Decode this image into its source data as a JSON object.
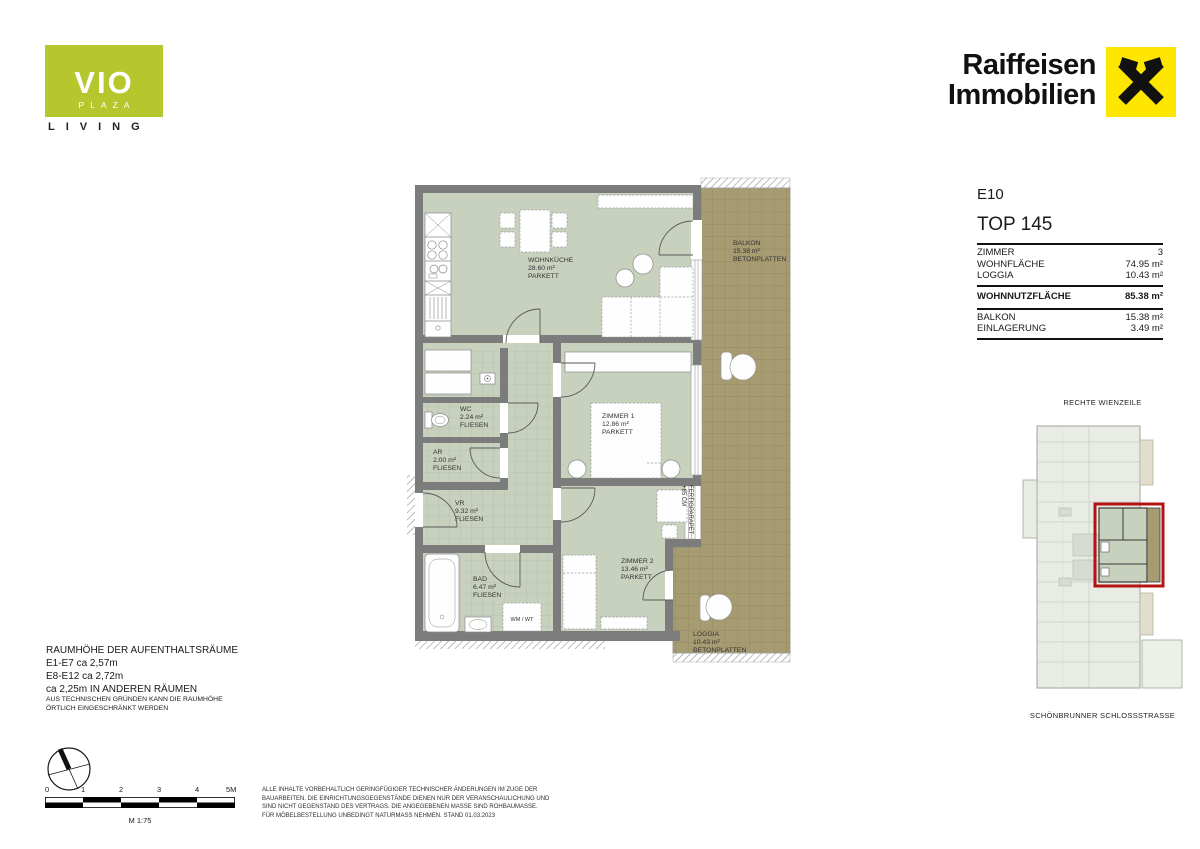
{
  "branding": {
    "vio_name": "VIO",
    "vio_sub": "PLAZA",
    "vio_tag": "LIVING",
    "raiffeisen_l1": "Raiffeisen",
    "raiffeisen_l2": "Immobilien"
  },
  "unit": {
    "floor": "E10",
    "top_number": "TOP 145",
    "rows": [
      {
        "label": "ZIMMER",
        "value": "3"
      },
      {
        "label": "WOHNFLÄCHE",
        "value": "74.95 m²"
      },
      {
        "label": "LOGGIA",
        "value": "10.43 m²"
      }
    ],
    "total": {
      "label": "WOHNNUTZFLÄCHE",
      "value": "85.38 m²"
    },
    "extras": [
      {
        "label": "BALKON",
        "value": "15.38 m²"
      },
      {
        "label": "EINLAGERUNG",
        "value": "3.49 m²"
      }
    ]
  },
  "floorplan": {
    "rooms": [
      {
        "name": "WOHNKÜCHE",
        "area": "28.60 m²",
        "floor": "PARKETT"
      },
      {
        "name": "BALKON",
        "area": "15.38 m²",
        "floor": "BETONPLATTEN"
      },
      {
        "name": "ZIMMER 1",
        "area": "12.86 m²",
        "floor": "PARKETT"
      },
      {
        "name": "WC",
        "area": "2.24 m²",
        "floor": "FLIESEN"
      },
      {
        "name": "AR",
        "area": "2.00 m²",
        "floor": "FLIESEN"
      },
      {
        "name": "VR",
        "area": "9.32 m²",
        "floor": "FLIESEN"
      },
      {
        "name": "BAD",
        "area": "6.47 m²",
        "floor": "FLIESEN"
      },
      {
        "name": "ZIMMER 2",
        "area": "13.46 m²",
        "floor": "PARKETT"
      },
      {
        "name": "LOGGIA",
        "area": "10.43 m²",
        "floor": "BETONPLATTEN"
      }
    ],
    "annotations": {
      "parapet_l1": "FERTIGPARAPET",
      "parapet_l2": "+85 CM",
      "washer": "WM / WT"
    }
  },
  "siteplan": {
    "street_top": "RECHTE WIENZEILE",
    "street_bottom": "SCHÖNBRUNNER SCHLOSSSTRASSE"
  },
  "notes": {
    "height_title": "RAUMHÖHE DER AUFENTHALTSRÄUME",
    "height_lines": [
      "E1-E7 ca 2,57m",
      "E8-E12 ca 2,72m",
      "ca 2,25m IN ANDEREN RÄUMEN"
    ],
    "height_small": [
      "AUS TECHNISCHEN GRÜNDEN KANN DIE RAUMHÖHE",
      "ÖRTLICH EINGESCHRÄNKT WERDEN"
    ],
    "disclaimer": [
      "ALLE INHALTE VORBEHALTLICH GERINGFÜGIGER TECHNISCHER ÄNDERUNGEN IM ZUGE DER",
      "BAUARBEITEN. DIE EINRICHTUNGSGEGENSTÄNDE DIENEN NUR DER VERANSCHAULICHUNG UND",
      "SIND NICHT GEGENSTAND DES VERTRAGS. DIE ANGEGEBENEN MASSE SIND ROHBAUMASSE.",
      "FÜR MÖBELBESTELLUNG UNBEDINGT NATURMASS NEHMEN. STAND 01.03.2023"
    ]
  },
  "scalebar": {
    "ticks": [
      "0",
      "1",
      "2",
      "3",
      "4",
      "5M"
    ],
    "label": "M 1:75"
  },
  "colors": {
    "vio_green": "#b5c72c",
    "raiffeisen_yellow": "#ffe600",
    "highlight_red": "#b51212",
    "room_green": "#c8d1bd",
    "balcony_tan": "#a79b72",
    "wall_gray": "#7c7c7c"
  }
}
